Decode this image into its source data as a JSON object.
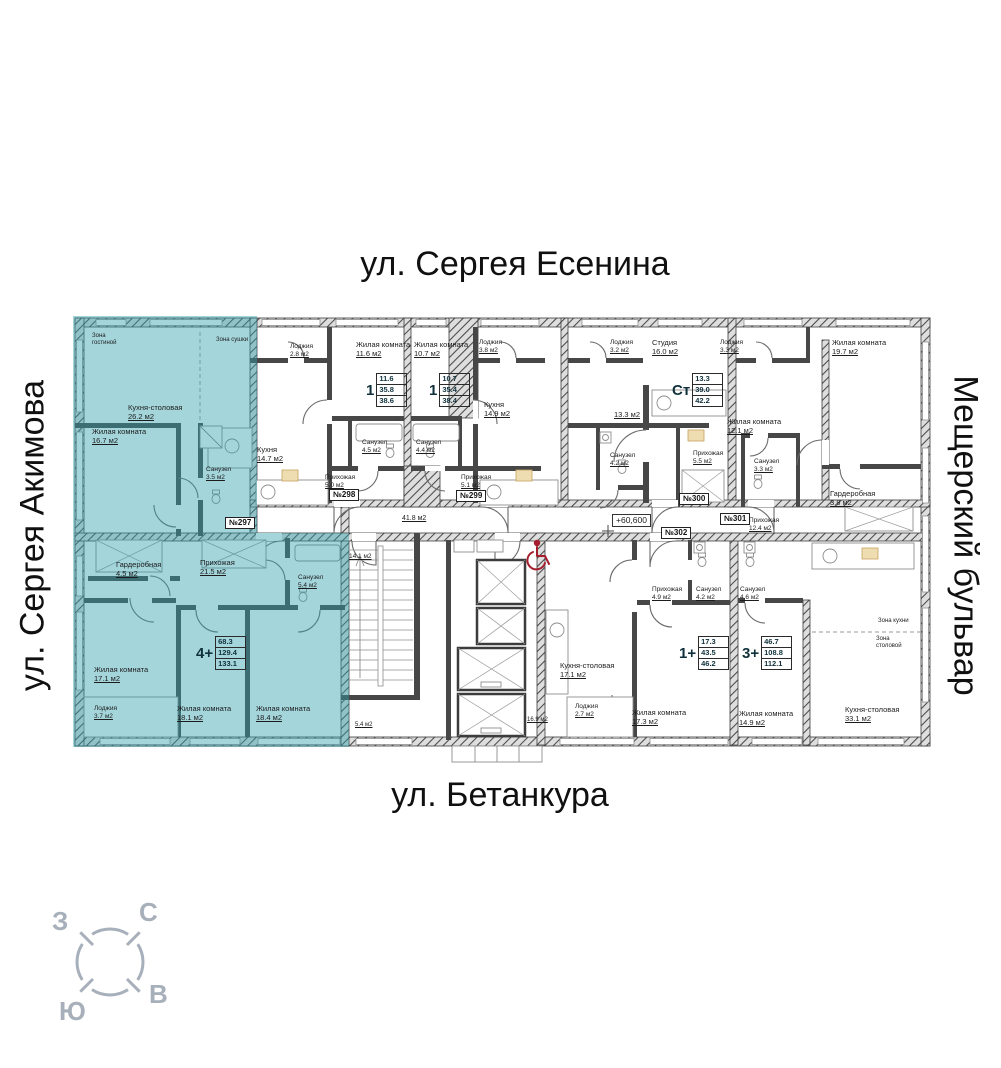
{
  "streets": {
    "top": "ул. Сергея Есенина",
    "left": "ул. Сергея Акимова",
    "right": "Мещерский бульвар",
    "bottom": "ул. Бетанкура"
  },
  "compass": {
    "n": "С",
    "s": "Ю",
    "w": "З",
    "e": "В"
  },
  "elevation_mark": "+60,600",
  "colors": {
    "highlight": "#2f9fae",
    "wall": "#3f3f3f",
    "wheelchair_red": "#a51e2d",
    "compass_gray": "#a6afba"
  },
  "apartments": [
    {
      "tag": "№297",
      "type": "4+",
      "areas": [
        "68.3",
        "129.4",
        "133.1"
      ],
      "tag_x": 225,
      "tag_y": 517,
      "label_x": 196,
      "label_y": 637
    },
    {
      "tag": "№298",
      "type": "1",
      "areas": [
        "11.6",
        "35.8",
        "38.6"
      ],
      "tag_x": 329,
      "tag_y": 489,
      "label_x": 366,
      "label_y": 374
    },
    {
      "tag": "№299",
      "type": "1",
      "areas": [
        "10.7",
        "35.4",
        "38.4"
      ],
      "tag_x": 456,
      "tag_y": 490,
      "label_x": 429,
      "label_y": 374
    },
    {
      "tag": "№300",
      "type": "Ст",
      "areas": [
        "13.3",
        "39.0",
        "42.2"
      ],
      "tag_x": 679,
      "tag_y": 493,
      "label_x": 672,
      "label_y": 374
    },
    {
      "tag": "№301",
      "type": "3+",
      "areas": [
        "46.7",
        "108.8",
        "112.1"
      ],
      "tag_x": 720,
      "tag_y": 513,
      "label_x": 742,
      "label_y": 637
    },
    {
      "tag": "№302",
      "type": "1+",
      "areas": [
        "17.3",
        "43.5",
        "46.2"
      ],
      "tag_x": 661,
      "tag_y": 527,
      "label_x": 679,
      "label_y": 637
    }
  ],
  "rooms": [
    {
      "name": "Зона гостиной",
      "area": "",
      "x": 92,
      "y": 333,
      "fs": 6,
      "w": 34,
      "ws": "normal"
    },
    {
      "name": "Зона сушки",
      "area": "",
      "x": 216,
      "y": 337,
      "fs": 6
    },
    {
      "name": "Кухня-столовая",
      "area": "26.2 м2",
      "x": 128,
      "y": 404
    },
    {
      "name": "Жилая комната",
      "area": "16.7 м2",
      "x": 92,
      "y": 428
    },
    {
      "name": "Санузел",
      "area": "3.5 м2",
      "x": 206,
      "y": 466,
      "fs": 6.5
    },
    {
      "name": "Гардеробная",
      "area": "4.5 м2",
      "x": 116,
      "y": 561
    },
    {
      "name": "Прихожая",
      "area": "21.5 м2",
      "x": 200,
      "y": 559
    },
    {
      "name": "Санузел",
      "area": "5.4 м2",
      "x": 298,
      "y": 574,
      "fs": 6.5
    },
    {
      "name": "Жилая комната",
      "area": "17.1 м2",
      "x": 94,
      "y": 666
    },
    {
      "name": "Лоджия",
      "area": "3.7 м2",
      "x": 94,
      "y": 705,
      "fs": 6.5
    },
    {
      "name": "Жилая комната",
      "area": "18.1 м2",
      "x": 177,
      "y": 705
    },
    {
      "name": "Жилая комната",
      "area": "18.4 м2",
      "x": 256,
      "y": 705
    },
    {
      "name": "Лоджия",
      "area": "2.8 м2",
      "x": 290,
      "y": 343,
      "fs": 6.5
    },
    {
      "name": "Жилая комната",
      "area": "11.6 м2",
      "x": 356,
      "y": 341
    },
    {
      "name": "Кухня",
      "area": "14.7 м2",
      "x": 257,
      "y": 446
    },
    {
      "name": "Санузел",
      "area": "4.5 м2",
      "x": 362,
      "y": 439,
      "fs": 6.5
    },
    {
      "name": "Прихожая",
      "area": "5.0 м2",
      "x": 325,
      "y": 474,
      "fs": 6.5
    },
    {
      "name": "Жилая комната",
      "area": "10.7 м2",
      "x": 414,
      "y": 341
    },
    {
      "name": "Лоджия",
      "area": "3.8 м2",
      "x": 479,
      "y": 339,
      "fs": 6.5
    },
    {
      "name": "Кухня",
      "area": "14.9 м2",
      "x": 484,
      "y": 401
    },
    {
      "name": "Санузел",
      "area": "4.4 м2",
      "x": 416,
      "y": 439,
      "fs": 6.5
    },
    {
      "name": "Прихожая",
      "area": "5.1 м2",
      "x": 461,
      "y": 474,
      "fs": 6.5
    },
    {
      "name": "Лоджия",
      "area": "3.2 м2",
      "x": 610,
      "y": 339,
      "fs": 6.5
    },
    {
      "name": "Студия",
      "area": "16.0 м2",
      "x": 652,
      "y": 339
    },
    {
      "name": "",
      "area": "13.3 м2",
      "x": 614,
      "y": 411
    },
    {
      "name": "Санузел",
      "area": "4.2 м2",
      "x": 610,
      "y": 452,
      "fs": 6.5
    },
    {
      "name": "Прихожая",
      "area": "5.5 м2",
      "x": 693,
      "y": 450,
      "fs": 6.5
    },
    {
      "name": "Лоджия",
      "area": "3.3 м2",
      "x": 720,
      "y": 339,
      "fs": 6.5
    },
    {
      "name": "Жилая комната",
      "area": "12.1 м2",
      "x": 727,
      "y": 418
    },
    {
      "name": "Санузел",
      "area": "3.3 м2",
      "x": 754,
      "y": 458,
      "fs": 6.5
    },
    {
      "name": "Жилая комната",
      "area": "19.7 м2",
      "x": 832,
      "y": 339
    },
    {
      "name": "Гардеробная",
      "area": "3.8 м2",
      "x": 830,
      "y": 490
    },
    {
      "name": "Прихожая",
      "area": "12.4 м2",
      "x": 749,
      "y": 517,
      "fs": 6.5
    },
    {
      "name": "Санузел",
      "area": "4.6 м2",
      "x": 740,
      "y": 586,
      "fs": 6.5
    },
    {
      "name": "Жилая комната",
      "area": "14.9 м2",
      "x": 739,
      "y": 710
    },
    {
      "name": "Зона кухни",
      "area": "",
      "x": 878,
      "y": 618,
      "fs": 6
    },
    {
      "name": "Зона столовой",
      "area": "",
      "x": 876,
      "y": 636,
      "fs": 6,
      "w": 34,
      "ws": "normal"
    },
    {
      "name": "Кухня-столовая",
      "area": "33.1 м2",
      "x": 845,
      "y": 706
    },
    {
      "name": "Прихожая",
      "area": "4.9 м2",
      "x": 652,
      "y": 586,
      "fs": 6.5
    },
    {
      "name": "Санузел",
      "area": "4.2 м2",
      "x": 696,
      "y": 586,
      "fs": 6.5
    },
    {
      "name": "Кухня-столовая",
      "area": "17.1 м2",
      "x": 560,
      "y": 662
    },
    {
      "name": "Лоджия",
      "area": "2.7 м2",
      "x": 575,
      "y": 703,
      "fs": 6.5
    },
    {
      "name": "Жилая комната",
      "area": "17.3 м2",
      "x": 632,
      "y": 709
    },
    {
      "name": "",
      "area": "41.8 м2",
      "x": 402,
      "y": 515,
      "fs": 7
    },
    {
      "name": "",
      "area": "14.1 м2",
      "x": 349,
      "y": 553,
      "fs": 6.5
    },
    {
      "name": "",
      "area": "16.9 м2",
      "x": 527,
      "y": 717,
      "fs": 6
    },
    {
      "name": "",
      "area": "5.4 м2",
      "x": 355,
      "y": 722,
      "fs": 6
    }
  ]
}
